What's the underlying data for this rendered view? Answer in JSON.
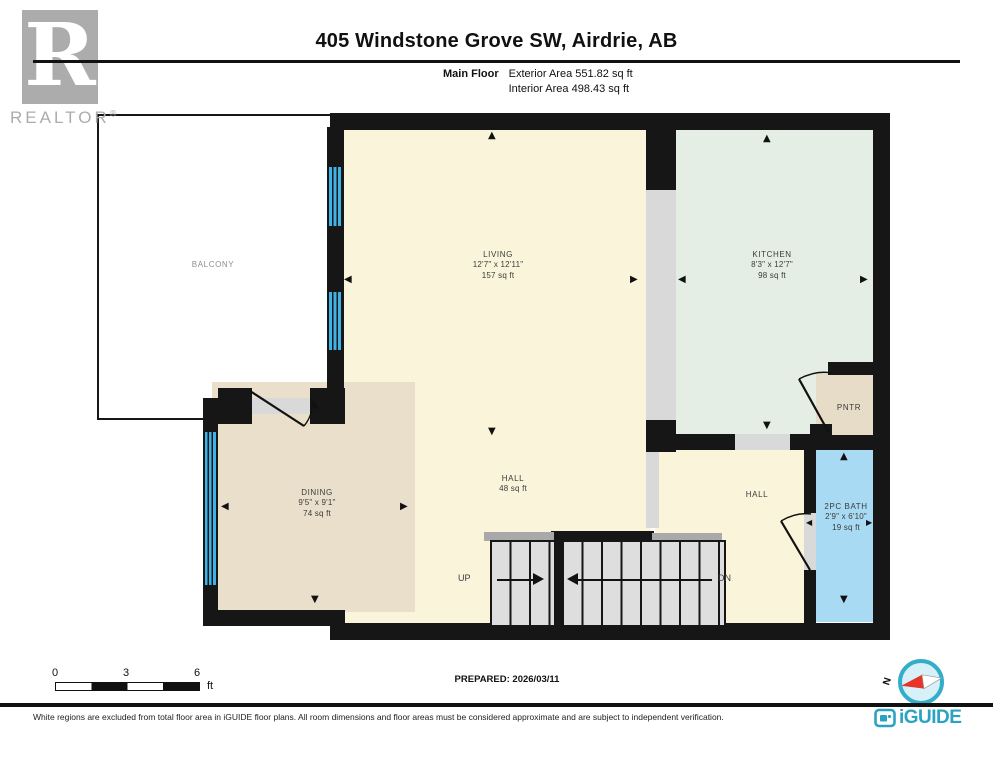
{
  "header": {
    "title": "405 Windstone Grove SW, Airdrie, AB",
    "floor_label": "Main Floor",
    "exterior_area": "Exterior Area 551.82 sq ft",
    "interior_area": "Interior Area 498.43 sq ft"
  },
  "branding": {
    "realtor_r": "R",
    "realtor_word": "REALTOR",
    "registered_symbol": "®",
    "iguide_logo_text": "iGUIDE"
  },
  "rooms": {
    "balcony": {
      "name": "BALCONY"
    },
    "living": {
      "name": "LIVING",
      "dimensions": "12'7\" x 12'11\"",
      "area": "157 sq ft"
    },
    "kitchen": {
      "name": "KITCHEN",
      "dimensions": "8'3\" x 12'7\"",
      "area": "98 sq ft"
    },
    "dining": {
      "name": "DINING",
      "dimensions": "9'5\" x 9'1\"",
      "area": "74 sq ft"
    },
    "hall_center": {
      "name": "HALL",
      "area": "48 sq ft"
    },
    "hall_right": {
      "name": "HALL"
    },
    "bath": {
      "name": "2PC BATH",
      "dimensions": "2'9\" x 6'10\"",
      "area": "19 sq ft"
    },
    "pantry": {
      "name": "PNTR"
    }
  },
  "stairs": {
    "up_label": "UP",
    "down_label": "DN"
  },
  "scale_bar": {
    "tick_0": "0",
    "tick_3": "3",
    "tick_6": "6",
    "unit": "ft"
  },
  "compass": {
    "north_label": "N"
  },
  "footer": {
    "prepared_label": "PREPARED: 2026/03/11",
    "disclaimer": "White regions are excluded from total floor area in iGUIDE floor plans. All room dimensions and floor areas must be considered approximate and are subject to independent verification."
  },
  "glyphs": {
    "arrow_up": "▲",
    "arrow_down": "▼",
    "arrow_left": "◀",
    "arrow_right": "▶"
  },
  "colors": {
    "wall": "#161616",
    "living_floor": "#FAF4DB",
    "kitchen_floor": "#E4EEE4",
    "dining_floor": "#EADFCB",
    "bath_floor": "#A9DAF3",
    "pantry_floor": "#E7DCC7",
    "window_blue": "#3FB2E6",
    "opening_gray": "#D9D9D9",
    "iguide_teal": "#2AA3C2",
    "compass_red": "#E8332A"
  }
}
